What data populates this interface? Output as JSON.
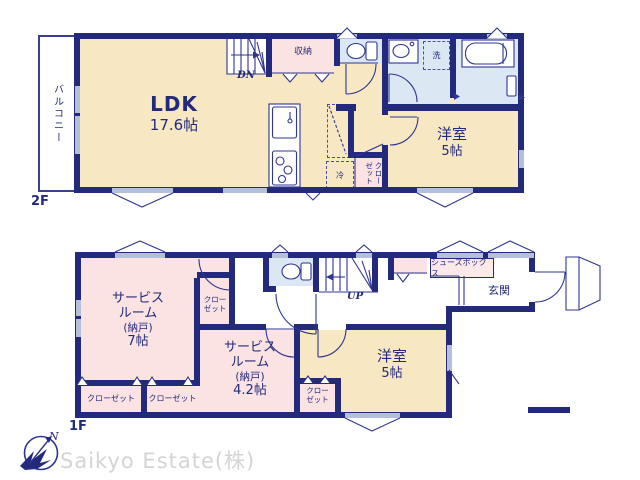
{
  "floor2": {
    "title": "2F",
    "balcony": "バルコニー",
    "ldk_name": "LDK",
    "ldk_size": "17.6帖",
    "stairs": "DN",
    "storage": "収納",
    "laundry": "洗",
    "fridge": "冷",
    "closet_line1": "クロー",
    "closet_line2": "ゼット",
    "western_name": "洋室",
    "western_size": "5帖"
  },
  "floor1": {
    "title": "1F",
    "service7": [
      "サービス",
      "ルーム",
      "(納戸)",
      "7帖"
    ],
    "service42": [
      "サービス",
      "ルーム",
      "(納戸)",
      "4.2帖"
    ],
    "western_name": "洋室",
    "western_size": "5帖",
    "closet_a": "クローゼット",
    "closet_b": "クローゼット",
    "closet_c_line1": "クロー",
    "closet_c_line2": "ゼット",
    "closet_d_line1": "クロー",
    "closet_d_line2": "ゼット",
    "stairs": "UP",
    "storage": "収納",
    "shoebox": "シューズボックス",
    "entrance": "玄関"
  },
  "compass": {
    "north": "N"
  },
  "watermark": "Saikyo Estate(株)",
  "colors": {
    "wall": "#232a7c",
    "room_cream": "#f7e7c3",
    "room_pink": "#fbe3e3",
    "room_blue": "#dbe8f4",
    "thin_line": "#2f3590",
    "window_gray": "#b6bfd8",
    "watermark_gray": "#d4d4d4"
  }
}
